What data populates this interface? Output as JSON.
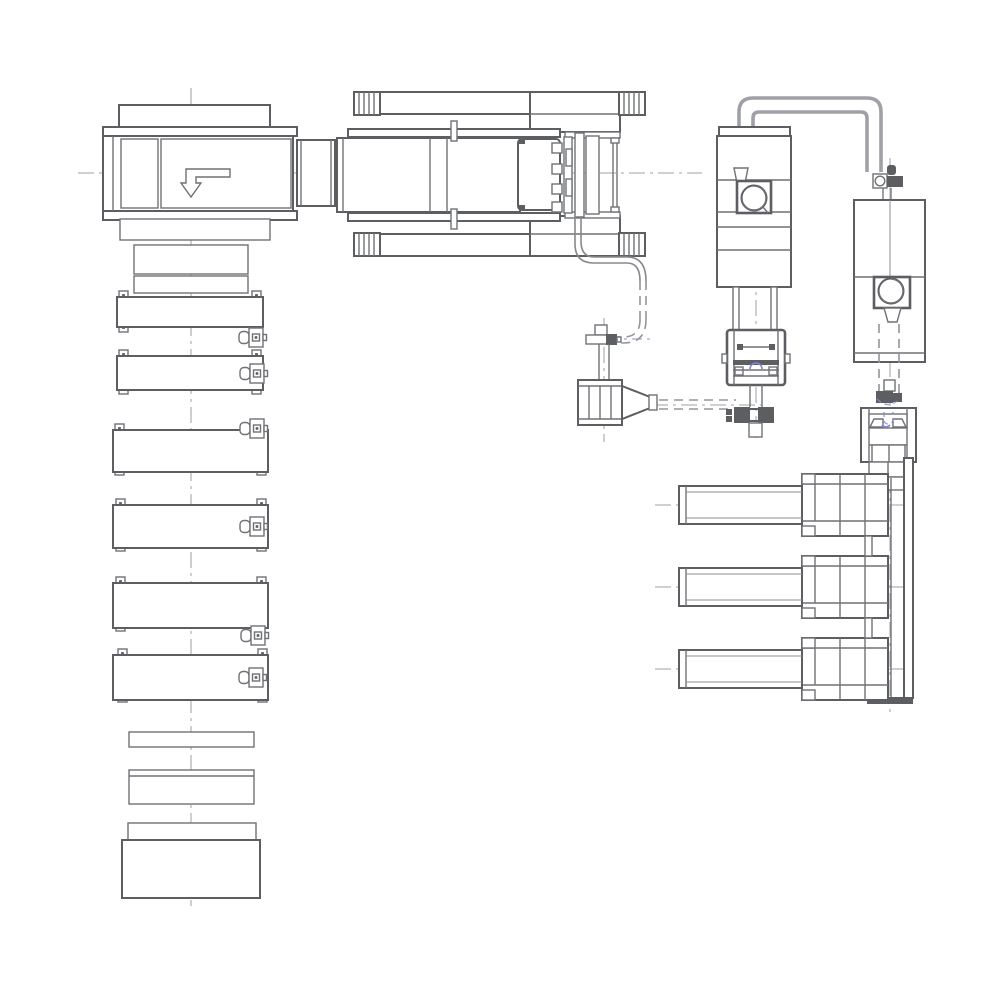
{
  "meta": {
    "title": "Machinery arrangement engineering drawing — plan view (monochrome CAD linework, no text labels)",
    "drawing_type": "cad-line-drawing"
  },
  "palette": {
    "line_dark": "#5d5e62",
    "line_medium": "#707175",
    "line_light": "#8d8e92",
    "pipe_gray": "#a0a1a6",
    "pipe_wall": "#87888c",
    "dash_gray": "#94959a",
    "centerline_gray": "#b4b5b8",
    "accent_blue": "#8286d8",
    "background": "#ffffff"
  },
  "components": [
    {
      "id": "machine-1-infeed-unit",
      "label": "Infeed machine with bent down-arrow symbol"
    },
    {
      "id": "transfer-stand",
      "label": "Transfer stand below infeed machine"
    },
    {
      "id": "conveyor-station-line",
      "label": "Six roller conveyor stations with corner feet and drive motors"
    },
    {
      "id": "outfeed-plates",
      "label": "Outfeed plates and end box"
    },
    {
      "id": "press-unit",
      "label": "Horizontal press/clamp unit with hatched frame rails and bolted platen"
    },
    {
      "id": "press-feed-pipe",
      "label": "Flexible pipe from press platen, solid then dashed, to cross fitting"
    },
    {
      "id": "hopper-feeder",
      "label": "Hopper feeder with discharge cone and dashed feed lines"
    },
    {
      "id": "extruder-tower",
      "label": "Left vertical tower with blower volute, clamp head and die fitting"
    },
    {
      "id": "granulator-tower",
      "label": "Right vertical tower with blower volute and bearing block"
    },
    {
      "id": "overhead-transfer-pipes",
      "label": "Overhead double-wall transfer pipe loop with elbow fitting"
    },
    {
      "id": "pusher-cylinder-bank",
      "label": "Three horizontal pusher cylinders mounted on vertical rail"
    },
    {
      "id": "centerlines",
      "label": "Dash-dot construction centerlines"
    }
  ],
  "symbols": {
    "arrow_symbol": "bent outline arrow pointing down",
    "hatch_blocks": "striped rail end blocks (4 per press frame)",
    "corner_feet": "square foot pads with center dot",
    "motor_units": "rounded-cylinder + box drive motors on conveyor stations"
  }
}
